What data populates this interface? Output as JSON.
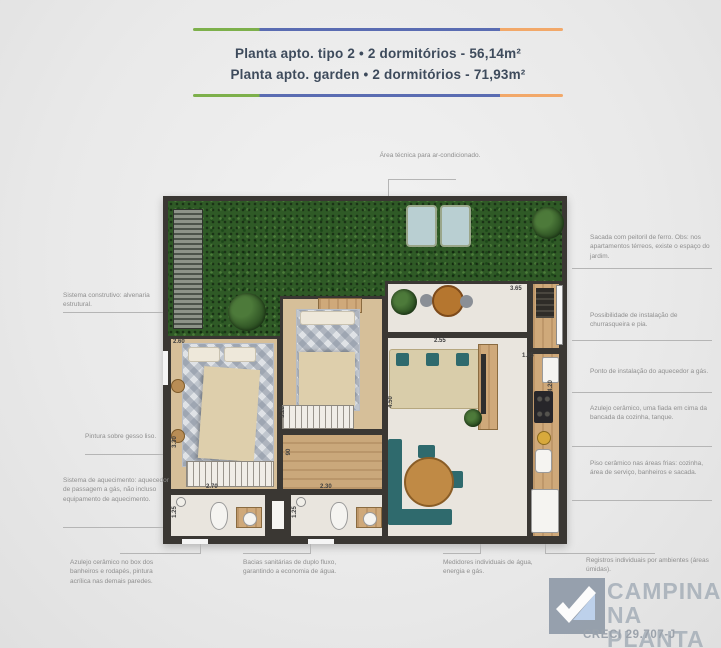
{
  "header": {
    "title_line1": "Planta apto. tipo 2 • 2 dormitórios - 56,14m²",
    "title_line2": "Planta apto. garden • 2 dormitórios - 71,93m²"
  },
  "annotations": {
    "top": "Área técnica para ar-condicionado.",
    "left": [
      "Sistema construtivo: alvenaria estrutural.",
      "Pintura sobre gesso liso.",
      "Sistema de aquecimento: aquecedor de passagem a gás, não incluso equipamento de aquecimento."
    ],
    "right": [
      "Sacada com peitoril de ferro. Obs: nos apartamentos térreos, existe o espaço do jardim.",
      "Possibilidade de instalação de churrasqueira e pia.",
      "Ponto de instalação do aquecedor a gás.",
      "Azulejo cerâmico, uma fiada em cima da bancada da cozinha, tanque.",
      "Piso cerâmico nas áreas frias: cozinha, área de serviço, banheiros e sacada."
    ],
    "bottom": [
      "Azulejo cerâmico no box dos banheiros e rodapés, pintura acrílica nas demais paredes.",
      "Bacias sanitárias de duplo fluxo, garantindo a economia de água.",
      "Medidores individuais de água, energia e gás.",
      "Registros individuais por ambientes (áreas úmidas)."
    ]
  },
  "dimensions": {
    "bedroom1_width": "2.60",
    "bedroom1_depth": "3.30",
    "bedroom2_depth": "3.20",
    "hallway_width": "90",
    "bath1_width": "2.70",
    "bath1_depth": "1.25",
    "bath2_width": "2.30",
    "bath2_depth": "1.25",
    "living_width": "2.55",
    "living_depth": "4.50",
    "balcony_width": "3.65",
    "service_width": "1.65",
    "kitchen_depth": "4.20"
  },
  "logo": {
    "line1": "CAMPINAS",
    "line2": "NA PLANTA",
    "creci": "CRECI 29.707-J"
  },
  "colors": {
    "wall": "#3a3733",
    "grass": "#2f5a26",
    "floor": "#e9e5de",
    "wood": "#cfa97a",
    "teal": "#2f6a6d",
    "bar-green": "#7db04b",
    "bar-blue": "#5a6cb2",
    "bar-orange": "#f2a869",
    "title-text": "#3e4b5c",
    "ann-text": "#8f8f8f",
    "logo-gray": "#a9b2bb",
    "logo-blue": "#b9cfec",
    "bed-beige": "#decfac"
  }
}
